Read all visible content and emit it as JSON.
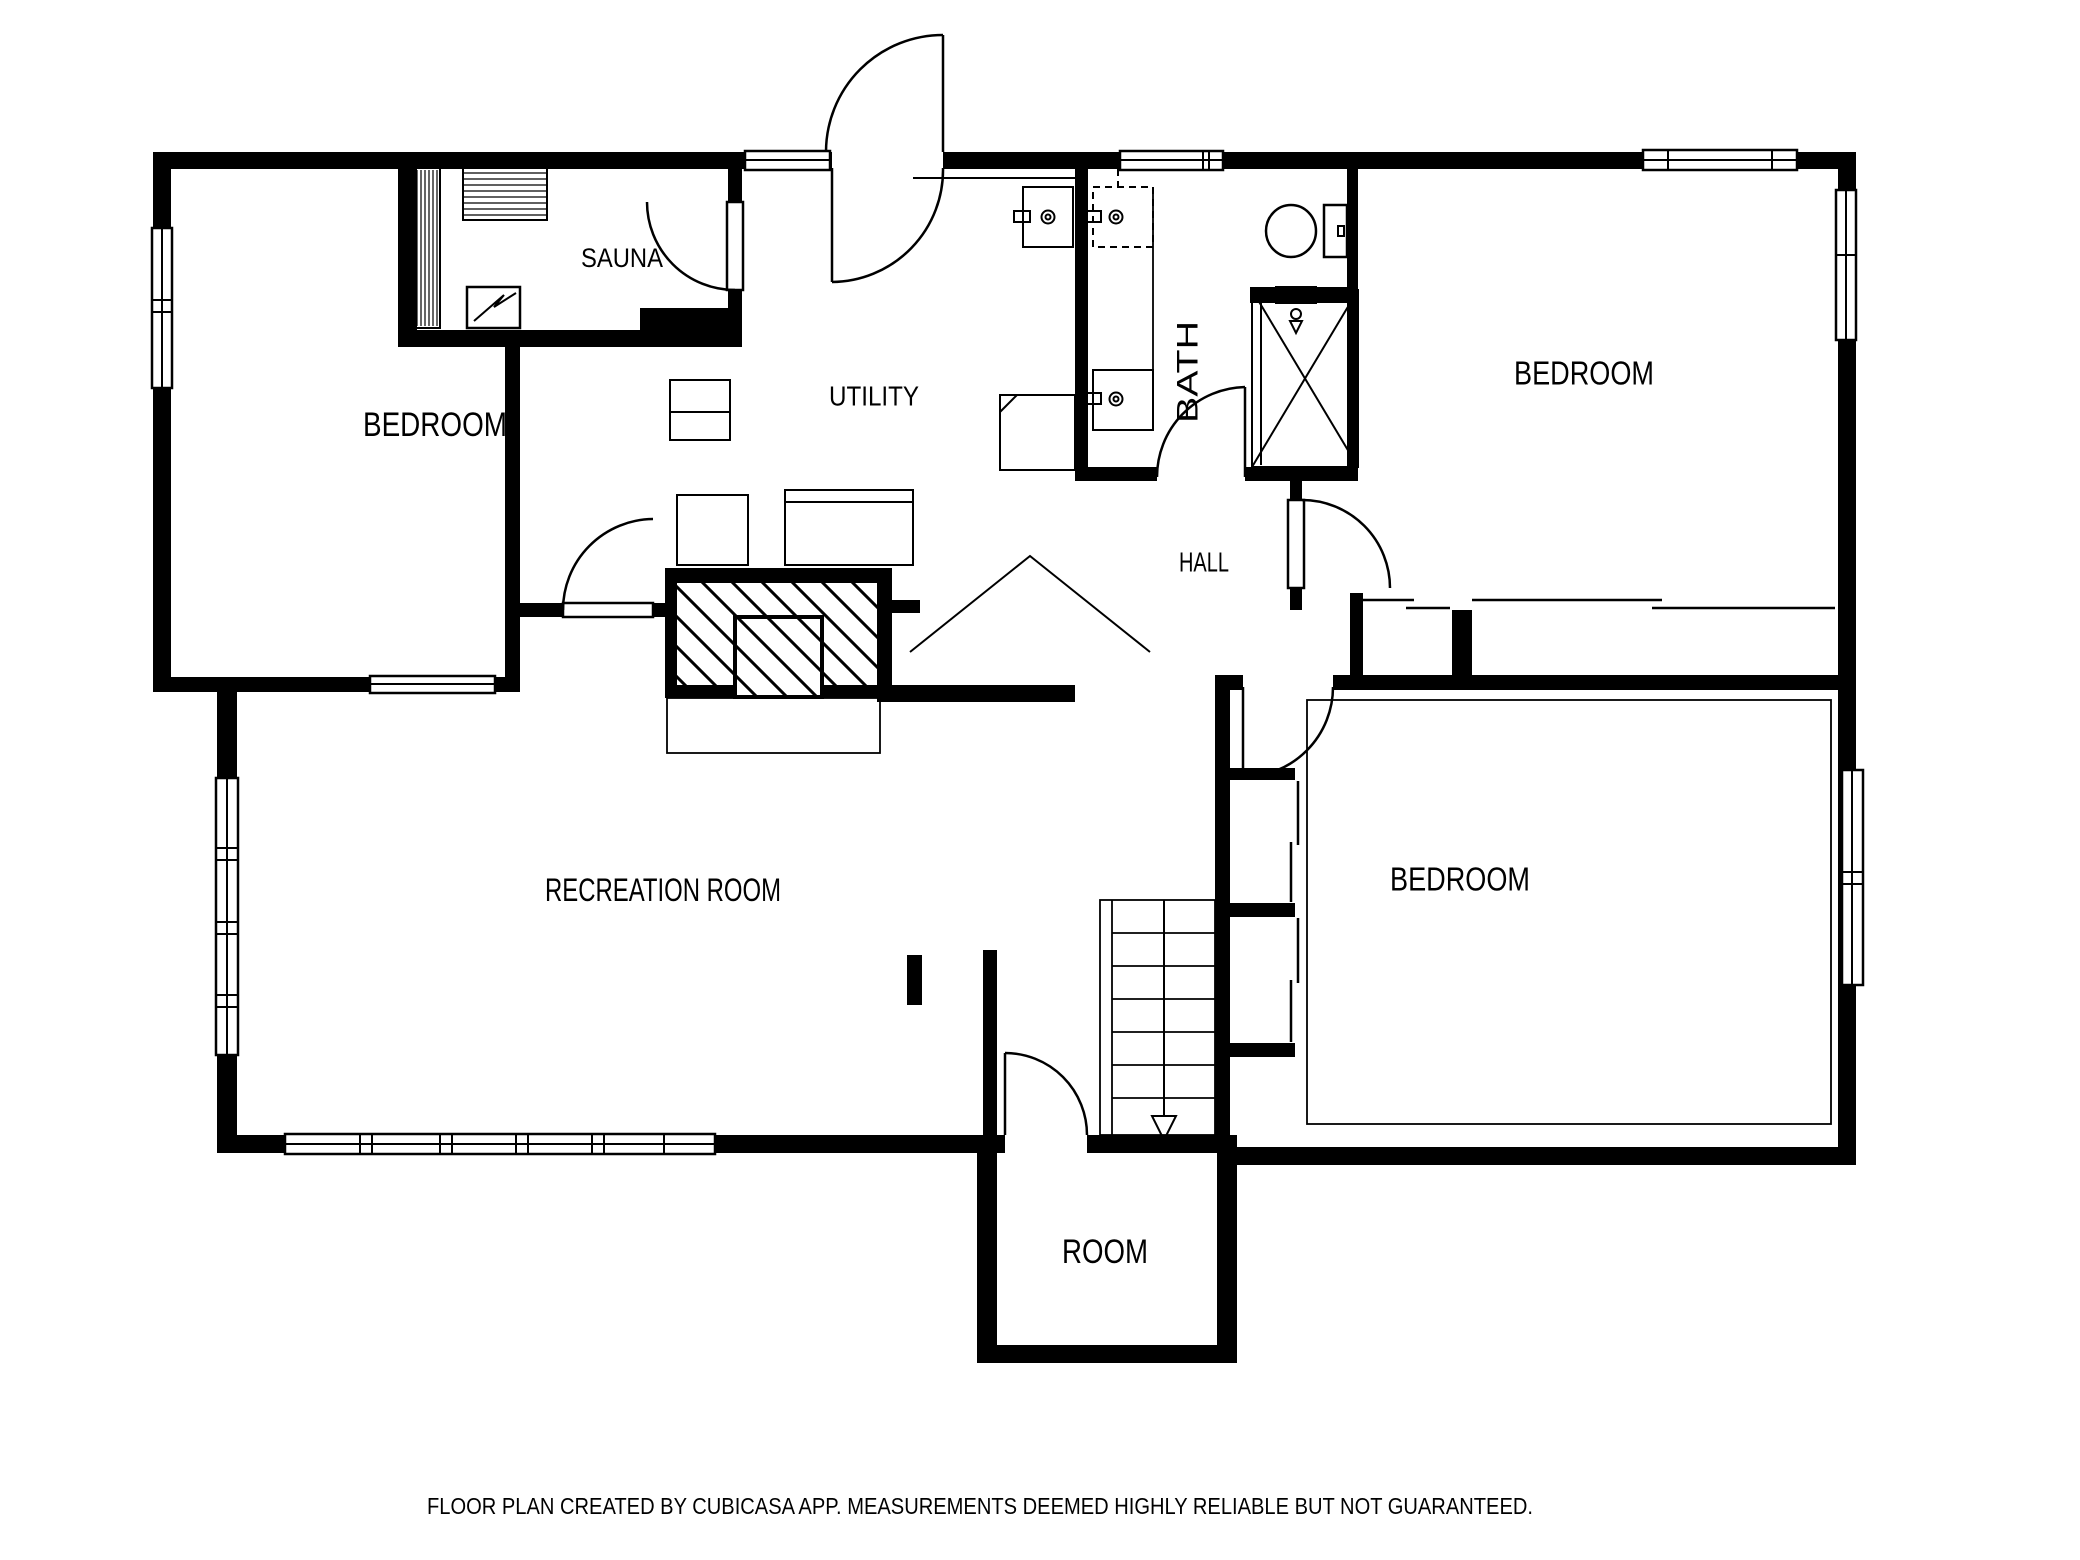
{
  "colors": {
    "ink": "#000000",
    "background": "#ffffff"
  },
  "rooms": [
    {
      "key": "bedroom-top-left",
      "label": "BEDROOM"
    },
    {
      "key": "sauna",
      "label": "SAUNA"
    },
    {
      "key": "utility",
      "label": "UTILITY"
    },
    {
      "key": "bath",
      "label": "BATH"
    },
    {
      "key": "bedroom-top-right",
      "label": "BEDROOM"
    },
    {
      "key": "hall",
      "label": "HALL"
    },
    {
      "key": "recreation-room",
      "label": "RECREATION ROOM"
    },
    {
      "key": "bedroom-bottom-right",
      "label": "BEDROOM"
    },
    {
      "key": "room",
      "label": "ROOM"
    }
  ],
  "footer": {
    "text": "FLOOR PLAN CREATED BY CUBICASA APP. MEASUREMENTS DEEMED HIGHLY RELIABLE BUT NOT GUARANTEED."
  }
}
